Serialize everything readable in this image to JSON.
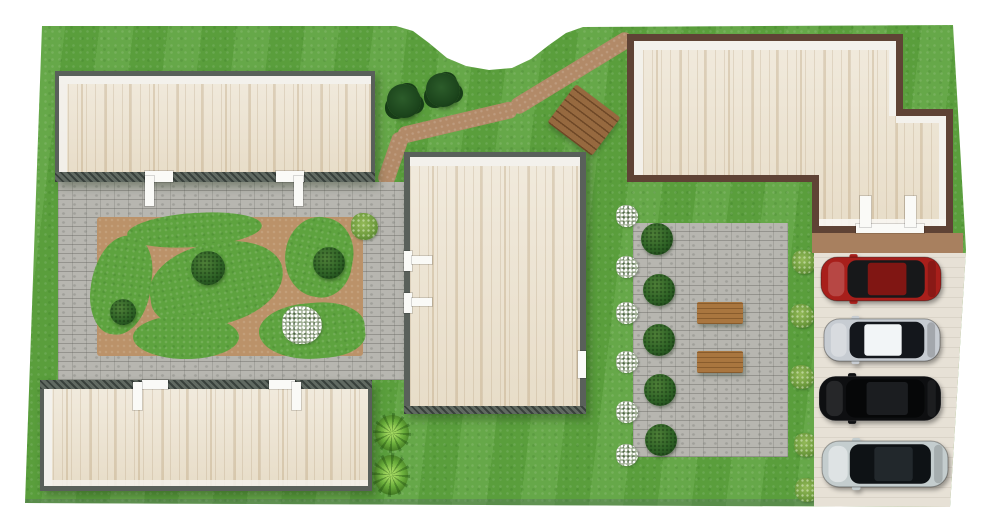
{
  "app": {
    "name": "3d-site-plan-render",
    "view": "top-down landscaped property"
  },
  "palette": {
    "background": "#ffffff",
    "grass": "#5ea33f",
    "grass_light": "#7cc45a",
    "grass_dark": "#3f7d28",
    "cobblestone": "#b7b6b0",
    "cobble_line": "#8e8d86",
    "garden_soil": "#bb9269",
    "path_dirt": "#b28a68",
    "terrace_dirt": "#a8805f",
    "parking_concrete": "#e7e1d6",
    "wood_floor": "#ece3d1",
    "wood_floor_streak": "#d8cbb0",
    "wall_gray": "#59605a",
    "wall_brown": "#5f4335",
    "wall_inner_white": "#f3f1ec",
    "door_white": "#fafaf7",
    "bush_green": "#2f6326",
    "tree_green": "#1c451c",
    "shrub_green": "#6f9c3e",
    "palm_green": "#6cb03c",
    "flower_white": "#ffffff",
    "table_wood": "#a9763f",
    "deck_wood": "#96693f",
    "edge_shadow": "rgba(90,110,100,0.35)"
  },
  "site": {
    "description": "Top-down 3D render: four roofless buildings with light wood plank floors, cobblestone courtyard around a soil garden bed with grass islands and round bushes, winding dirt path with wooden deck, cobblestone patio with five round bushes and two wooden benches, dirt terrace and concrete parking strip with four cars.",
    "buildings": [
      {
        "name": "north-west-building",
        "walls": "dark gray",
        "floor": "light wood planks",
        "doors": 2
      },
      {
        "name": "south-west-building",
        "walls": "dark gray",
        "floor": "light wood planks",
        "doors": 2
      },
      {
        "name": "central-building",
        "walls": "dark gray",
        "floor": "light wood planks",
        "doors": 3
      },
      {
        "name": "north-east-building",
        "walls": "dark brown",
        "floor": "light wood planks",
        "doors": 2,
        "shape": "L-shaped with grass notch"
      }
    ],
    "areas": [
      "courtyard",
      "garden-bed",
      "walking-path",
      "wooden-deck",
      "patio",
      "terrace",
      "parking"
    ],
    "vegetation": {
      "trees": 2,
      "garden_bushes": 3,
      "patio_bushes": 5,
      "flower_bushes": 7,
      "side_shrubs": 5,
      "palm_tufts": 2,
      "corner_shrub": 1
    },
    "furniture": {
      "patio_benches": 2
    }
  },
  "cars": [
    {
      "name": "red-suv",
      "body": "#a81f1b",
      "roof": "#801613",
      "glass": "#17181a"
    },
    {
      "name": "silver-sedan",
      "body": "#c7ccd2",
      "roof": "#f2f5f7",
      "glass": "#14171c"
    },
    {
      "name": "black-suv",
      "body": "#0e0f11",
      "roof": "#1b1d20",
      "glass": "#060708"
    },
    {
      "name": "pale-silver-sedan",
      "body": "#c4cdce",
      "roof": "#22282c",
      "glass": "#0e1215"
    }
  ]
}
